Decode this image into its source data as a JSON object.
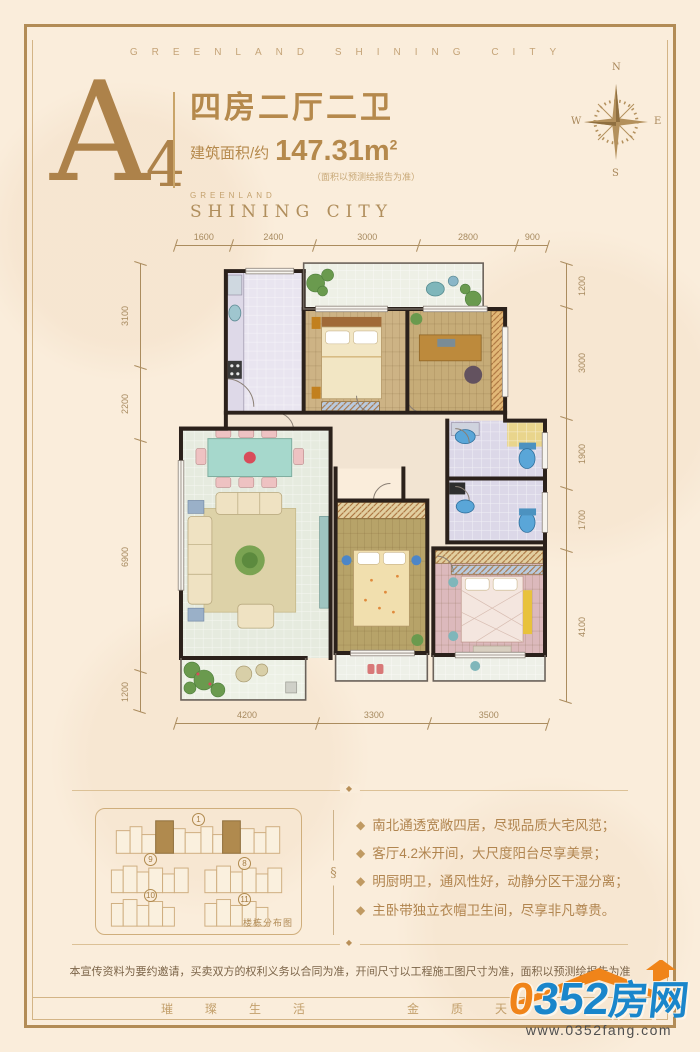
{
  "band_top": {
    "text": "GREENLAND SHINING CITY"
  },
  "band_bottom": {
    "left": "璀璨生活",
    "right": "金质天"
  },
  "header": {
    "unit_letter": "A",
    "unit_number": "4",
    "title": "四房二厅二卫",
    "area_label": "建筑面积/约",
    "area_value": "147.31m",
    "area_sup": "2",
    "area_note": "（面积以预测绘报告为准）",
    "brand_small": "GREENLAND",
    "brand_big": "SHINING CITY"
  },
  "compass": {
    "n": "N",
    "e": "E",
    "s": "S",
    "w": "W"
  },
  "plan": {
    "dims_top": [
      "1600",
      "2400",
      "3000",
      "2800",
      "900"
    ],
    "dims_left": [
      "3100",
      "2200",
      "6900",
      "1200"
    ],
    "dims_right": [
      "1200",
      "3000",
      "1900",
      "1700",
      "4100"
    ],
    "dims_bottom": [
      "4200",
      "3300",
      "3500"
    ]
  },
  "features": {
    "bullet": "◆",
    "items": [
      "南北通透宽敞四居，尽现品质大宅风范；",
      "客厅4.2米开间，大尺度阳台尽享美景；",
      "明厨明卫，通风性好，动静分区干湿分离；",
      "主卧带独立衣帽卫生间，尽享非凡尊贵。"
    ]
  },
  "building_map": {
    "label": "楼栋分布图",
    "numbers": [
      "1",
      "9",
      "8",
      "10",
      "11"
    ]
  },
  "ornaments": {
    "section_mark": "§",
    "line_mark": "◆"
  },
  "disclaimer": "本宣传资料为要约邀请，买卖双方的权利义务以合同为准，开间尺寸以工程施工图尺寸为准，面积以预测绘报告为准",
  "logo": {
    "zero": "0",
    "num": "352",
    "cn": "房网",
    "url": "www.0352fang.com"
  },
  "colors": {
    "gold": "#b5894c",
    "frame": "#b28c56",
    "logo_orange": "#f08419",
    "logo_blue": "#1a86cb"
  }
}
